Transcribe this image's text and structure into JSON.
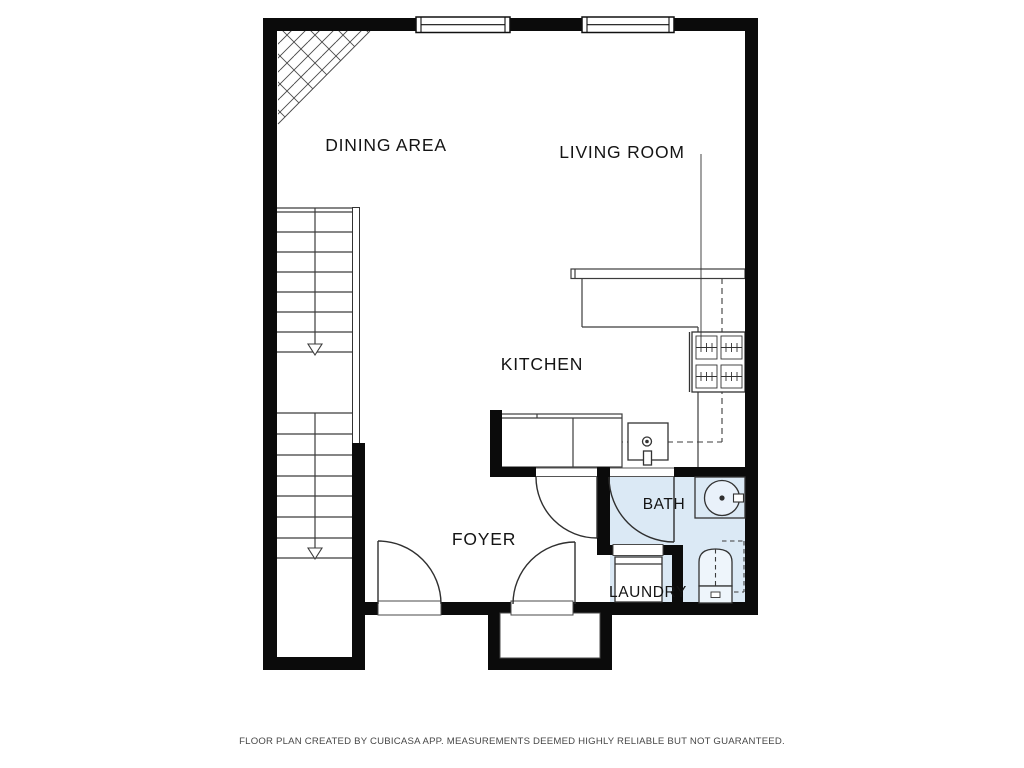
{
  "plan": {
    "rooms": [
      {
        "id": "dining",
        "label": "DINING AREA"
      },
      {
        "id": "living",
        "label": "LIVING ROOM"
      },
      {
        "id": "kitchen",
        "label": "KITCHEN"
      },
      {
        "id": "foyer",
        "label": "FOYER"
      },
      {
        "id": "bath",
        "label": "BATH"
      },
      {
        "id": "laundry",
        "label": "LAUNDRY"
      }
    ],
    "icons": [
      "stairs-down-arrow-icon",
      "stove-icon",
      "kitchen-sink-icon",
      "bath-sink-icon",
      "toilet-icon",
      "washer-icon",
      "window-icon",
      "door-swing-icon",
      "void-hatch-icon"
    ],
    "colors": {
      "wall-color": "#0b0b0b",
      "wet-room-fill": "#dbe9f5",
      "line-color": "#3c3c3c",
      "door-color": "#2f2f2f",
      "background": "#ffffff"
    }
  },
  "footer": {
    "disclaimer": "FLOOR PLAN CREATED BY CUBICASA APP. MEASUREMENTS DEEMED HIGHLY RELIABLE BUT NOT GUARANTEED."
  }
}
